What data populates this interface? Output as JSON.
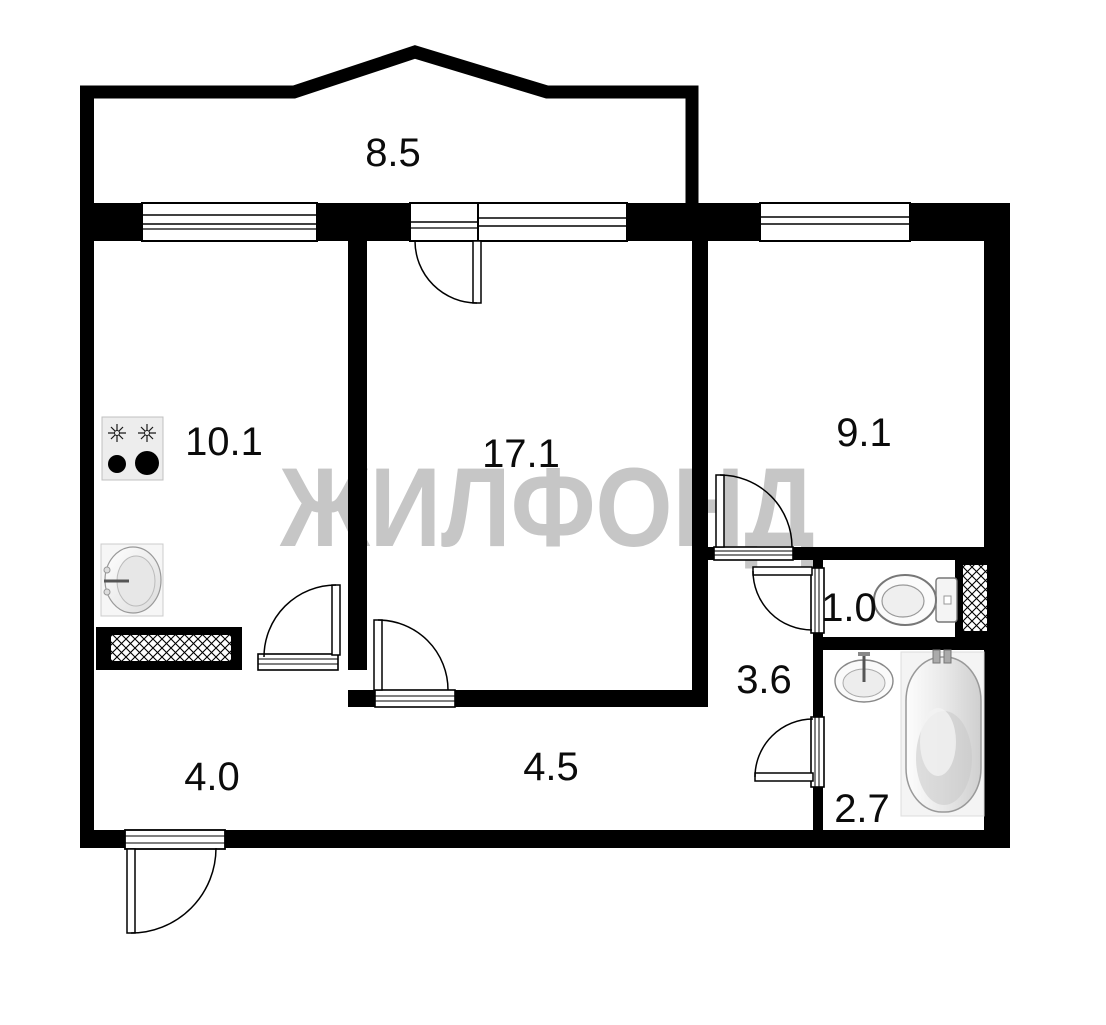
{
  "watermark": {
    "text": "ЖИЛФОНД",
    "color": "#c6c6c6"
  },
  "plan": {
    "wall_color": "#000000",
    "label_color": "#0b0b0b",
    "watermark_color": "#c6c6c6",
    "rooms": [
      {
        "key": "balcony",
        "area": "8.5"
      },
      {
        "key": "kitchen",
        "area": "10.1"
      },
      {
        "key": "living-room",
        "area": "17.1"
      },
      {
        "key": "bedroom",
        "area": "9.1"
      },
      {
        "key": "wc",
        "area": "1.0"
      },
      {
        "key": "hallway",
        "area": "3.6"
      },
      {
        "key": "bathroom",
        "area": "2.7"
      },
      {
        "key": "corridor-left",
        "area": "4.0"
      },
      {
        "key": "corridor-right",
        "area": "4.5"
      }
    ],
    "icons": [
      "stove-icon",
      "kitchen-sink-icon",
      "toilet-icon",
      "bath-sink-icon",
      "bathtub-icon",
      "vent-shaft-hatch-icon"
    ]
  }
}
